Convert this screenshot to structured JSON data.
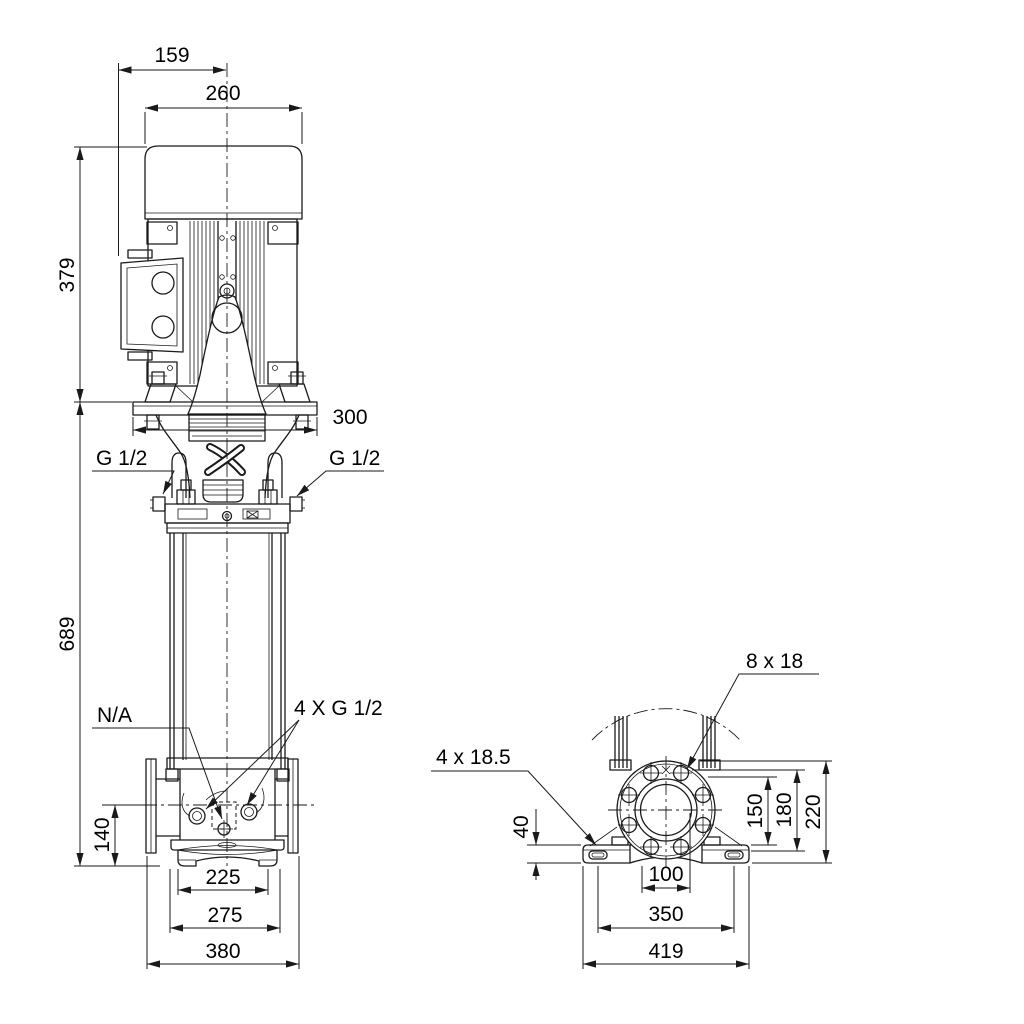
{
  "colors": {
    "background": "#ffffff",
    "line": "#1a1a1a",
    "text": "#000000"
  },
  "front_view": {
    "dims": {
      "terminal_box_to_center": "159",
      "motor_width": "260",
      "motor_height": "379",
      "motor_stool_flange_width": "300",
      "vent_plug_left": "G 1/2",
      "vent_plug_right": "G 1/2",
      "pump_length": "689",
      "drain_plug": "N/A",
      "gauge_plugs": "4 X G 1/2",
      "port_centerline_height": "140",
      "base_width_inner": "225",
      "base_width_middle": "275",
      "base_width_overall": "380"
    }
  },
  "side_view": {
    "dims": {
      "flange_bolt_holes": "8 x 18",
      "foot_bolt_holes": "4 x 18.5",
      "foot_height": "40",
      "flange_to_foot_top": "150",
      "flange_to_foot_step": "180",
      "flange_to_base_bottom": "220",
      "foot_width_inner": "100",
      "foot_hole_span": "350",
      "base_width_overall": "419"
    }
  }
}
